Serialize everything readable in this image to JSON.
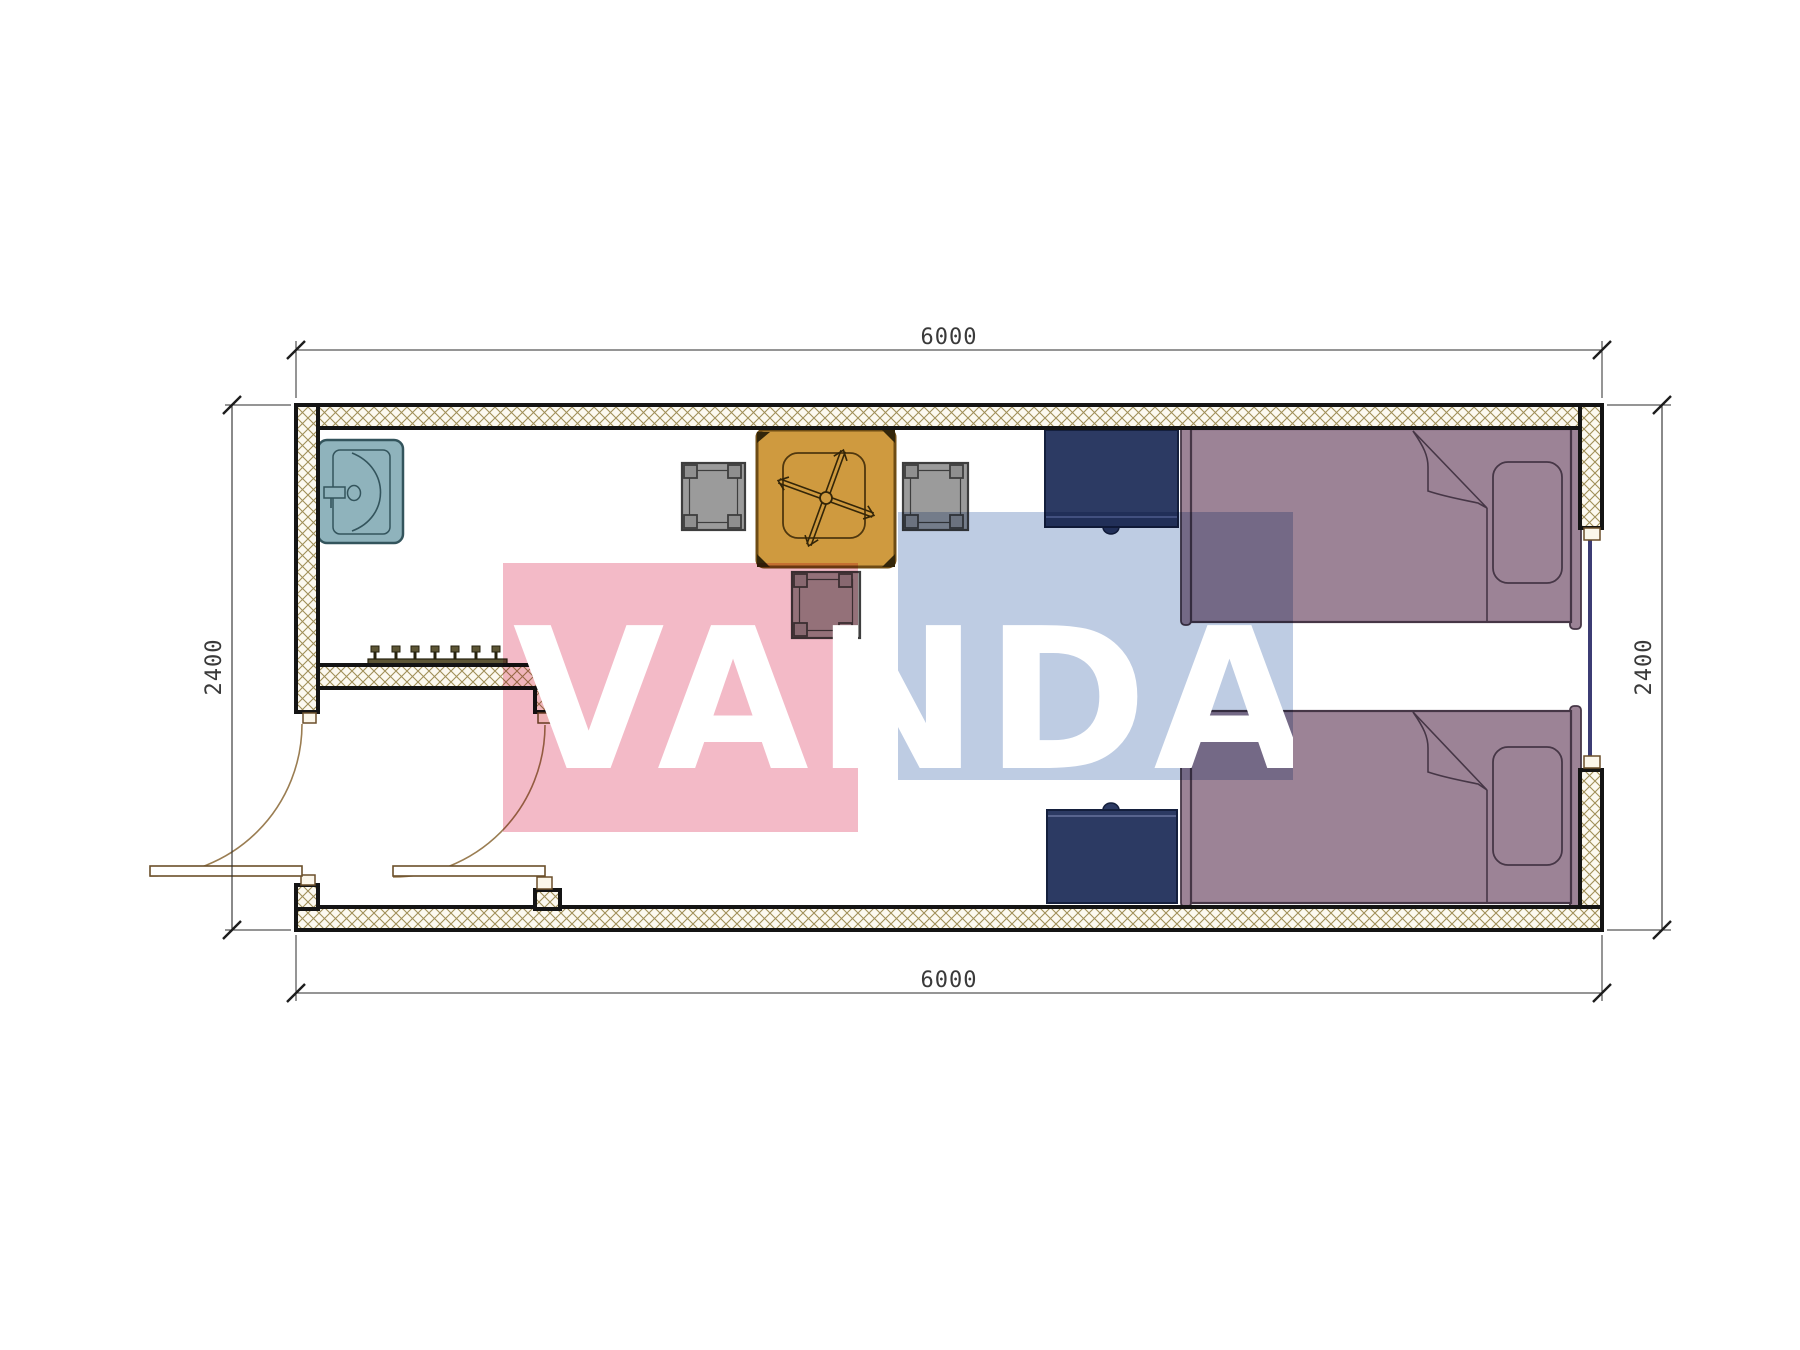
{
  "drawing": {
    "kind": "container-house-floor-plan",
    "watermark": {
      "text": "VANDA",
      "text_color": "#ffffff",
      "pink_color": "#f2b3c1",
      "blue_color": "#b7c7e0"
    },
    "dimensions": {
      "top": "6000",
      "bottom": "6000",
      "left": "2400",
      "right": "2400"
    },
    "plan": {
      "wall_outline_color": "#141414",
      "hatch_line_color": "#a08f58",
      "hatch_bg_color": "#fcf9f0",
      "window_color": "#3c3c74",
      "door_arc_color": "#9a7d52",
      "furniture": {
        "sink": {
          "name": "sink",
          "color": "#8fb3bc"
        },
        "table": {
          "name": "square-table",
          "color": "#cf9a3f"
        },
        "stool_left": {
          "name": "stool",
          "color": "#9b9b9b"
        },
        "stool_right": {
          "name": "stool",
          "color": "#9b9b9b"
        },
        "stool_bottom": {
          "name": "stool",
          "color": "#9b9b9b"
        },
        "nightstand_top": {
          "name": "nightstand",
          "color": "#2c3a63"
        },
        "nightstand_bottom": {
          "name": "nightstand",
          "color": "#2c3a63"
        },
        "bed_top": {
          "name": "single-bed",
          "color": "#9c8396"
        },
        "bed_bottom": {
          "name": "single-bed",
          "color": "#9c8396"
        },
        "coat_rack": {
          "name": "coat-rack",
          "color": "#5d5635"
        }
      }
    }
  }
}
